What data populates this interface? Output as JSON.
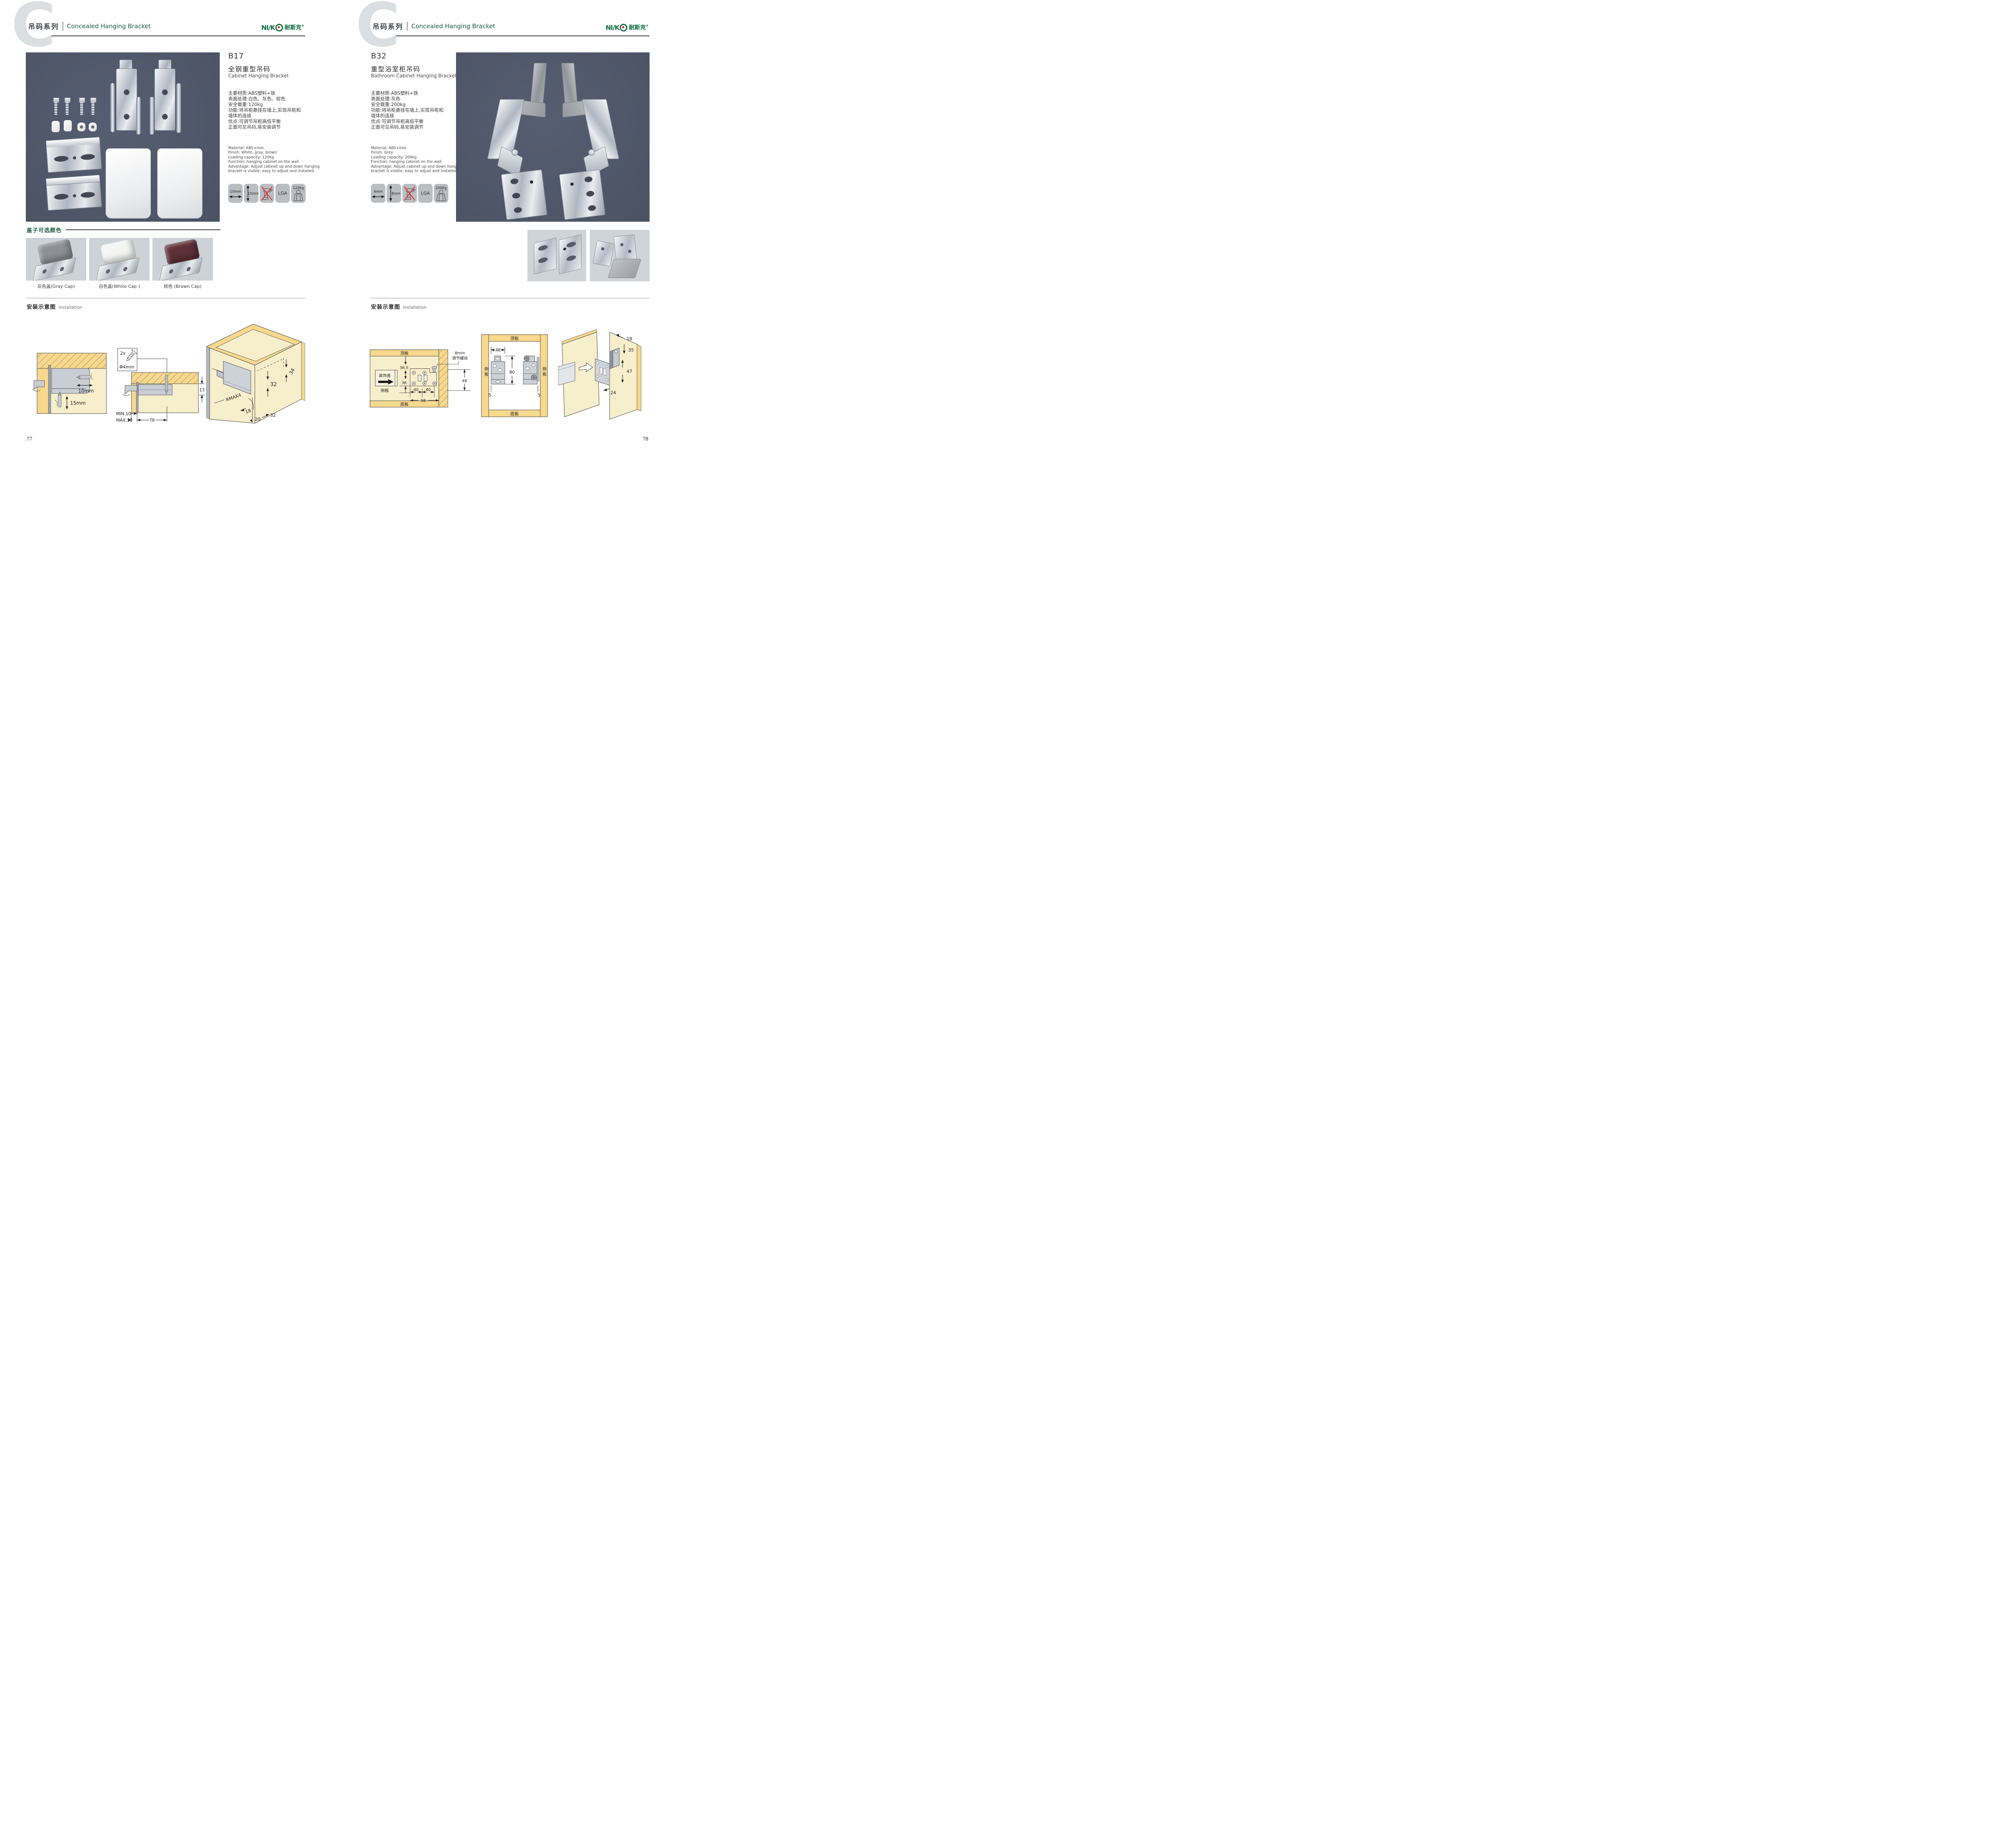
{
  "colors": {
    "accent_green": "#1c5c42",
    "logo_green": "#0e6e41",
    "logo_red": "#e60012",
    "photo_bg": "#4e5669",
    "icon_tile_bg": "#b9bec3",
    "cap_tile_bg": "#ccd2d7",
    "wood_yellow": "#f8d88c",
    "wood_light": "#f7eecb",
    "cross_red": "#e8312a"
  },
  "header": {
    "watermark": "C",
    "series_cn": "吊码系列",
    "series_en": "Concealed Hanging Bracket",
    "brand_latin": "NI/K",
    "brand_cn": "耐斯克",
    "brand_reg": "®"
  },
  "left": {
    "page_number": "77",
    "code": "B17",
    "name_cn": "全钢重型吊码",
    "name_en": "Cabinet Hanging Bracket",
    "specs_cn": [
      "主要材质:ABS塑料+铁",
      "表面处理:白色、灰色、棕色",
      "安全载重:120kg",
      "功能:将吊柜悬挂在墙上,实现吊柜和",
      "墙体的连接",
      "优点:可调节吊柜高低平衡",
      "正面可见吊码,易安装调节"
    ],
    "specs_en": [
      "Material: ABS+iron",
      "Finish: White, gray, brown",
      "Loading capacity: 120kg",
      "Function: hanging cabinet on the wall",
      "Advantage: Adjust cabinet up and down hanging",
      "bracket is visible, easy to adjust and installed"
    ],
    "icons": [
      {
        "name": "width-arrow-icon",
        "label": "10mm"
      },
      {
        "name": "height-arrow-icon",
        "label": "15mm"
      },
      {
        "name": "no-drill-icon",
        "label": ""
      },
      {
        "name": "lga-cert-icon",
        "label": "LGA"
      },
      {
        "name": "load-weight-icon",
        "label": "120Kg"
      }
    ],
    "caps_title": "盖子可选颜色",
    "caps": [
      {
        "label": "灰色盖(Gray Cap)",
        "color": "#8d9094"
      },
      {
        "label": "白色盖(White Cap )",
        "color": "#f5f5f4"
      },
      {
        "label": "棕色 (Brown Cap)",
        "color": "#5c3036"
      }
    ],
    "install_cn": "安装示意图",
    "install_en": "Installation",
    "d1": {
      "w": "10mm",
      "h": "15mm"
    },
    "d2": {
      "qty": "2x",
      "dia": "Φ4mm",
      "t13": "13",
      "min": "MIN.10",
      "max": "MAX.30",
      "w78": "78"
    },
    "d3": {
      "a34": "34",
      "a32": "32",
      "rmax": "RMAX4",
      "a18": "18",
      "a20": "20",
      "b32": "32"
    }
  },
  "right": {
    "page_number": "78",
    "code": "B32",
    "name_cn": "重型浴室柜吊码",
    "name_en": "Bathroom Cabinet Hanging Bracket",
    "specs_cn": [
      "主要材质:ABS塑料+铁",
      "表面处理:灰色",
      "安全载重:200kg",
      "功能:将吊柜悬挂在墙上,实现吊柜和",
      "墙体的连接",
      "优点:可调节吊柜高低平衡",
      "正面可见吊码,易安装调节"
    ],
    "specs_en": [
      "Material: ABS+iron",
      "Finish: Grey",
      "Loading capacity: 200kg",
      "Function: hanging cabinet on the wall",
      "Advantage: Adjust cabinet up and down hanging",
      "bracket is visible, easy to adjust and installed"
    ],
    "icons": [
      {
        "name": "width-arrow-icon",
        "label": "4mm"
      },
      {
        "name": "height-arrow-icon",
        "label": "8mm"
      },
      {
        "name": "no-drill-icon",
        "label": ""
      },
      {
        "name": "lga-cert-icon",
        "label": "LGA"
      },
      {
        "name": "load-weight-icon",
        "label": "200Kg"
      }
    ],
    "install_cn": "安装示意图",
    "install_en": "Installation",
    "d1": {
      "top": "顶板",
      "bottom": "底板",
      "side": "侧板",
      "cover": "装饰盖",
      "a365": "36.5",
      "a36": "36",
      "a40a": "40",
      "a40b": "40",
      "a98": "98",
      "note1": "8mm",
      "note2": "调节螺丝",
      "a48": "48"
    },
    "d2": {
      "top": "顶板",
      "bottom": "底板",
      "side_l": "侧板",
      "side_r": "侧板",
      "a48": "48",
      "a80": "80",
      "a5l": "5",
      "a5r": "5"
    },
    "d3": {
      "a18": "18",
      "a35": "35",
      "a47": "47",
      "a24": "24"
    }
  }
}
